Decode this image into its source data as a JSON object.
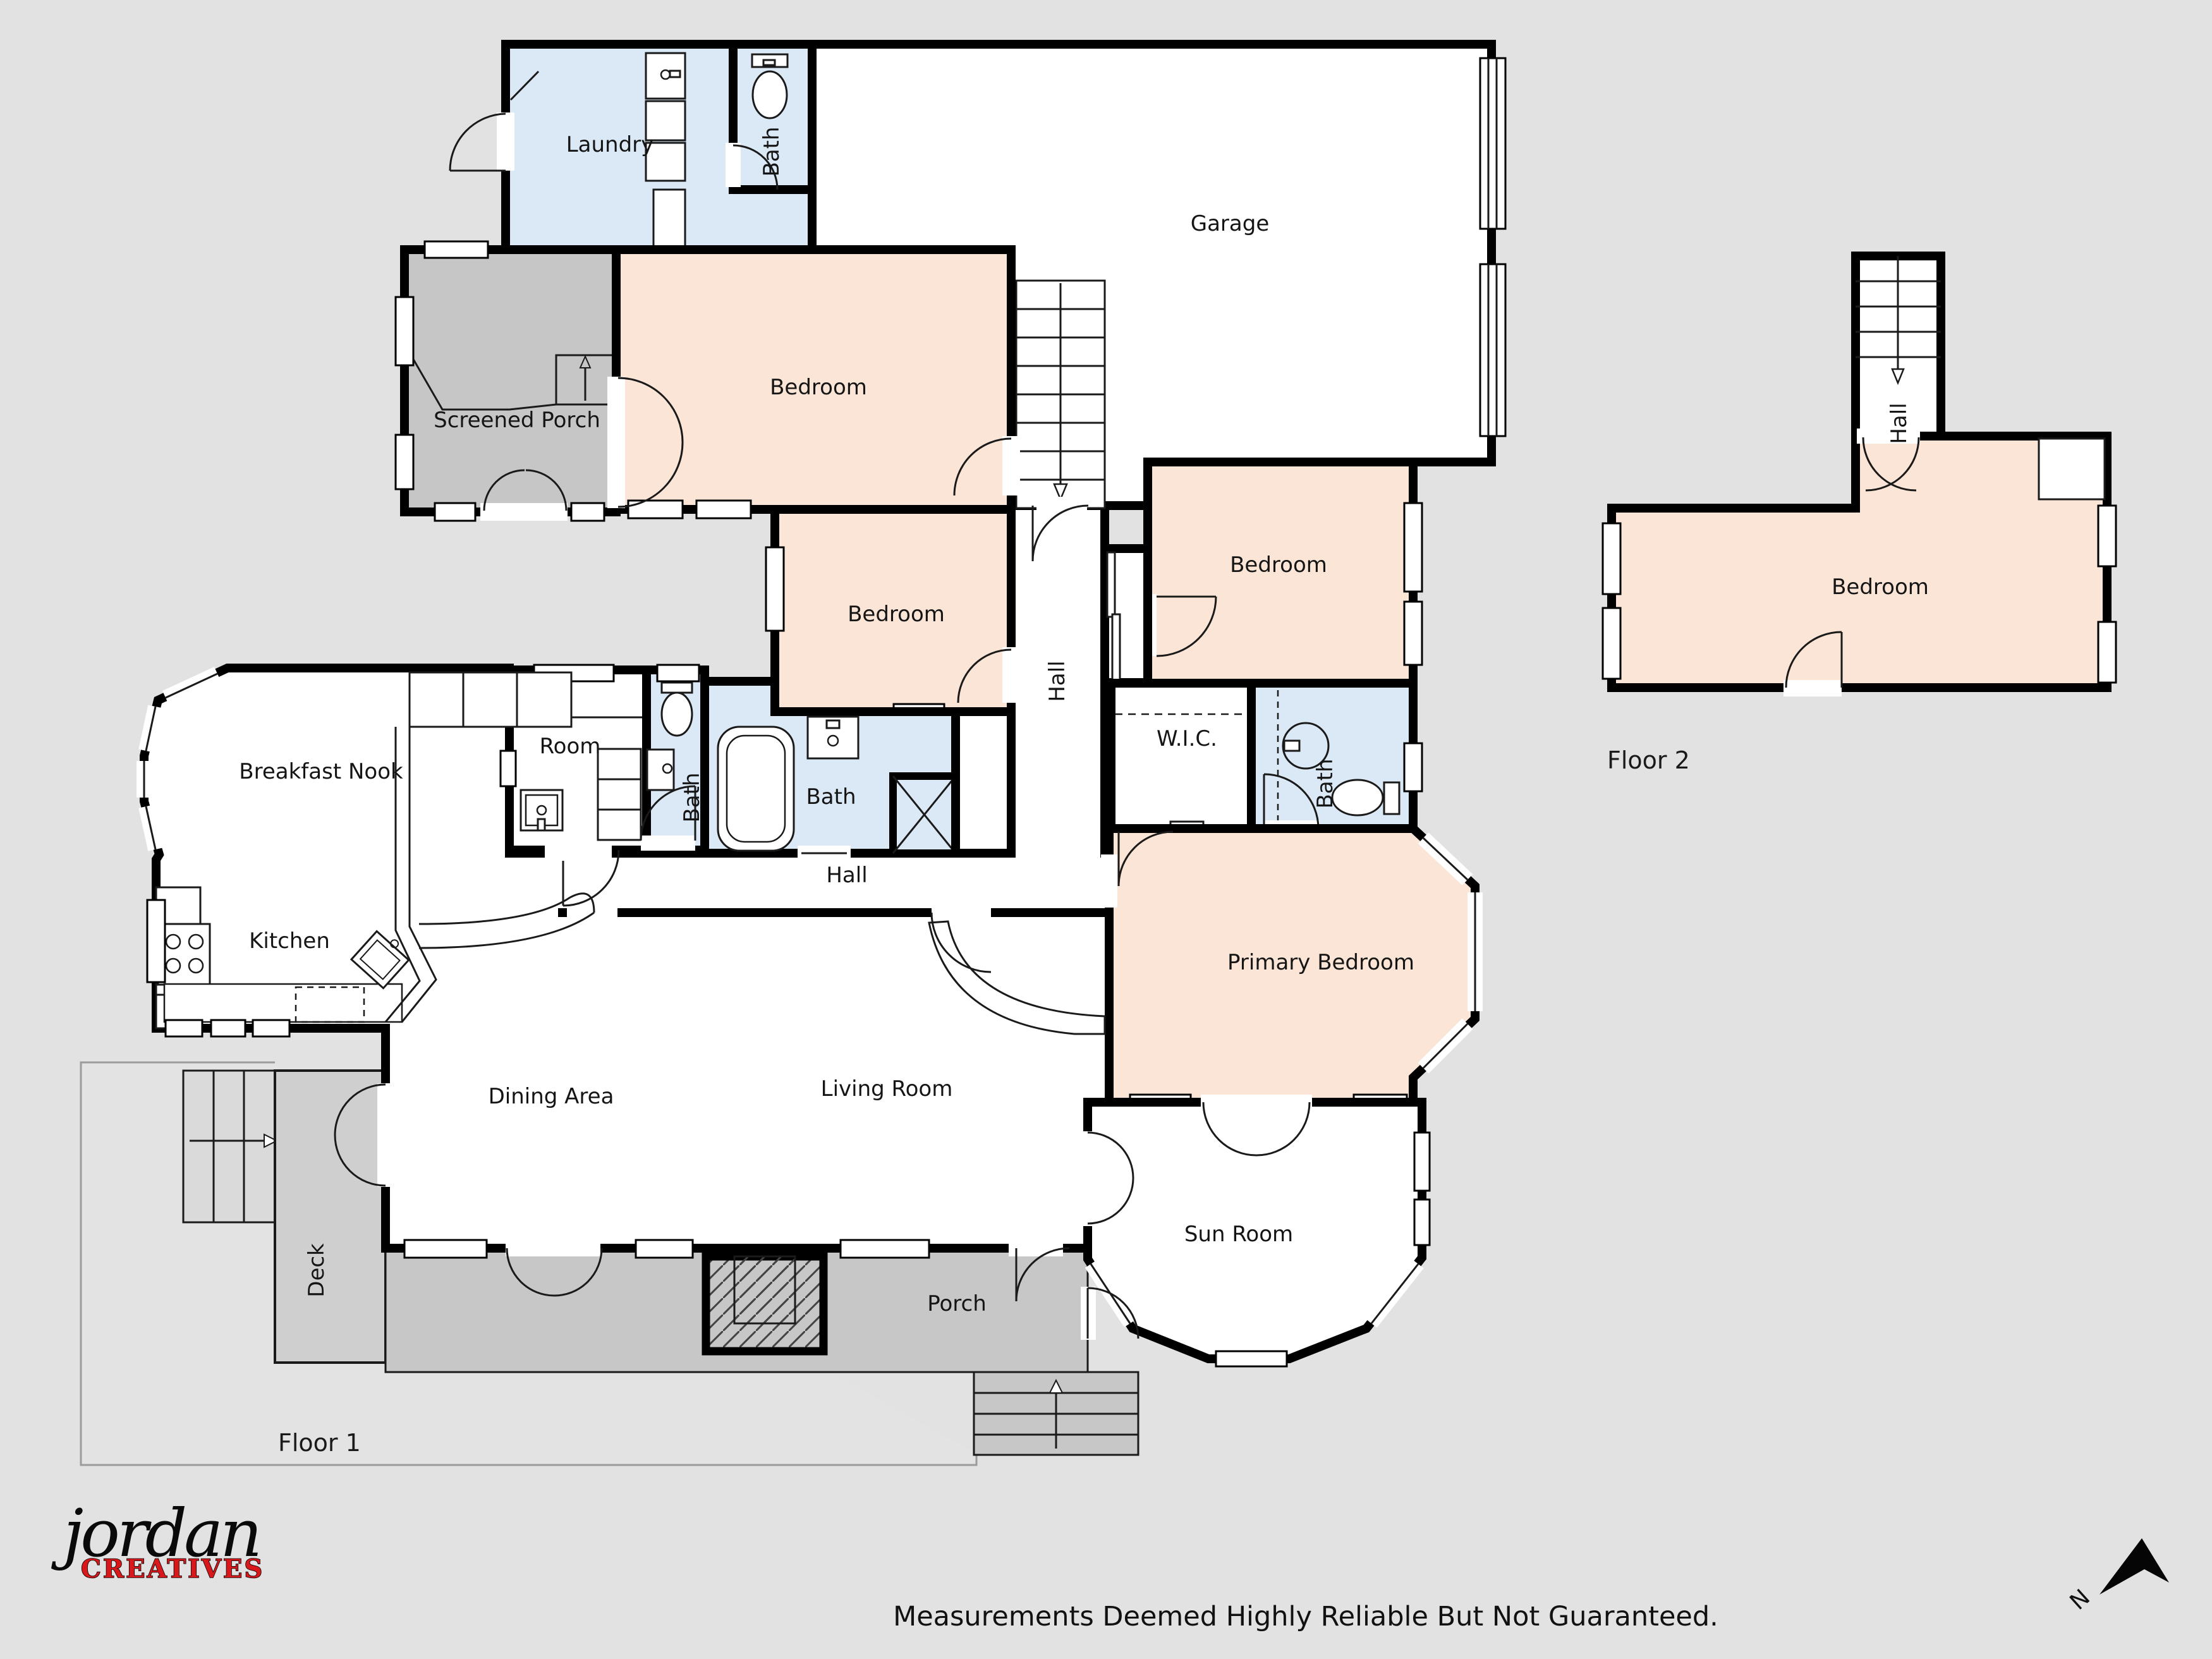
{
  "floor1": {
    "title": "Floor 1",
    "rooms": {
      "laundry": "Laundry",
      "bath_laundry": "Bath",
      "garage": "Garage",
      "screened_porch": "Screened Porch",
      "bedroom_nw": "Bedroom",
      "bedroom_mid": "Bedroom",
      "bedroom_e": "Bedroom",
      "hall_vertical": "Hall",
      "breakfast_nook": "Breakfast Nook",
      "room": "Room",
      "bath_small": "Bath",
      "bath_hall": "Bath",
      "hall": "Hall",
      "wic": "W.I.C.",
      "bath_primary": "Bath",
      "kitchen": "Kitchen",
      "dining": "Dining Area",
      "living": "Living Room",
      "primary_bedroom": "Primary Bedroom",
      "sun_room": "Sun Room",
      "deck": "Deck",
      "porch": "Porch"
    }
  },
  "floor2": {
    "title": "Floor 2",
    "rooms": {
      "hall": "Hall",
      "bedroom": "Bedroom"
    }
  },
  "footer": {
    "disclaimer": "Measurements Deemed Highly Reliable But Not Guaranteed."
  },
  "logo": {
    "name": "jordan",
    "tagline": "CREATIVES"
  },
  "compass": {
    "north": "N"
  },
  "colors": {
    "background": "#e2e2e2",
    "wall": "#000000",
    "bedroom_fill": "#fbe5d6",
    "bath_fill": "#dbe9f6",
    "porch_fill": "#c7c7c7",
    "deck_fill": "#cfcfcf",
    "stairs_fill": "#dadada",
    "logo_red": "#d9181b"
  }
}
